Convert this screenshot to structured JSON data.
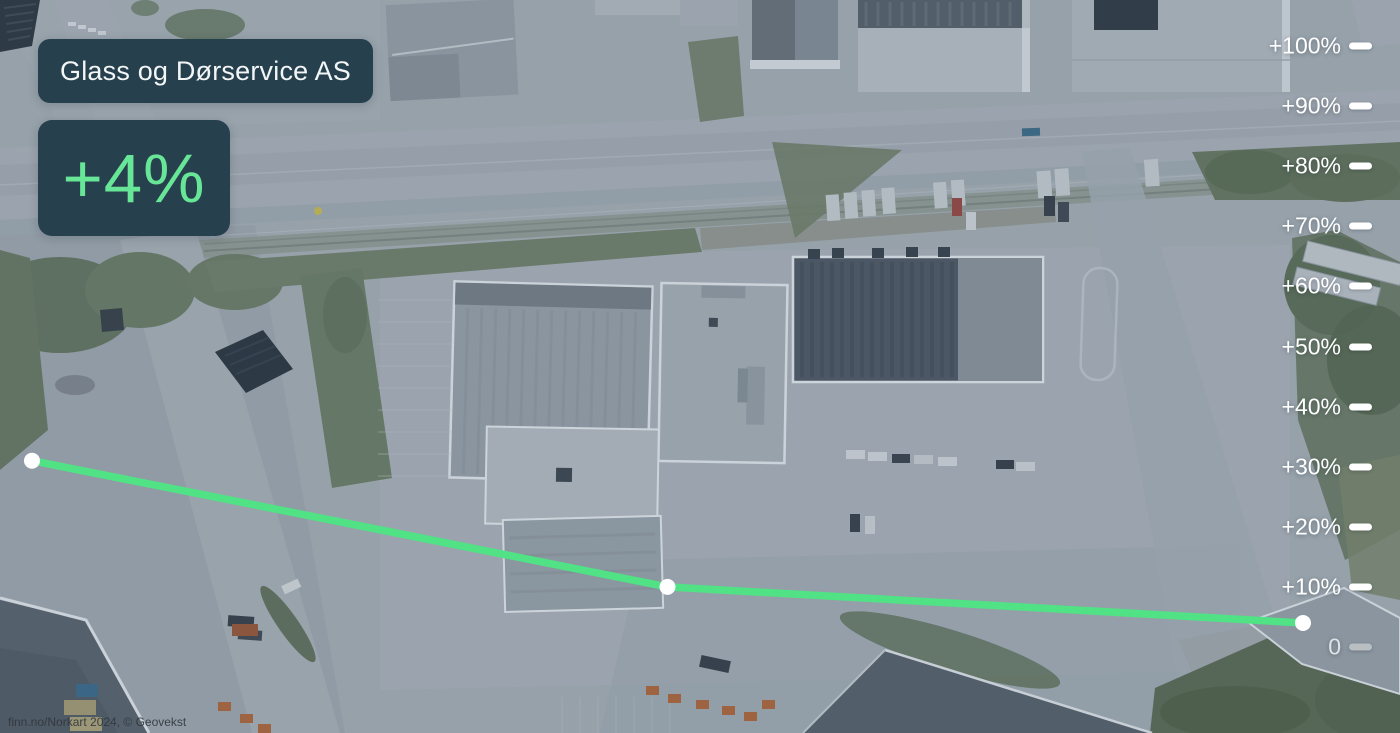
{
  "header": {
    "company_name": "Glass og Dørservice AS",
    "change_value": "+4%"
  },
  "chart_data": {
    "type": "line",
    "title": "Glass og Dørservice AS",
    "headline": "+4%",
    "x": [
      "",
      "",
      ""
    ],
    "series": [
      {
        "name": "Glass og Dørservice AS",
        "values": [
          31,
          10,
          4
        ]
      }
    ],
    "ylim": [
      0,
      100
    ],
    "ytick_labels": [
      "+100%",
      "+90%",
      "+80%",
      "+70%",
      "+60%",
      "+50%",
      "+40%",
      "+30%",
      "+20%",
      "+10%",
      "0"
    ],
    "muted_tick_label": "0",
    "grid": false,
    "legend_position": "none",
    "axis_side": "right",
    "line_color": "#50e284",
    "marker_color": "#ffffff"
  },
  "attribution": {
    "text": "finn.no/Norkart 2024, © Geovekst"
  },
  "colors": {
    "accent_green": "#68e697",
    "badge_background": "#27404d",
    "axis_label": "#ffffff",
    "muted_tick": "#b9bec2"
  }
}
